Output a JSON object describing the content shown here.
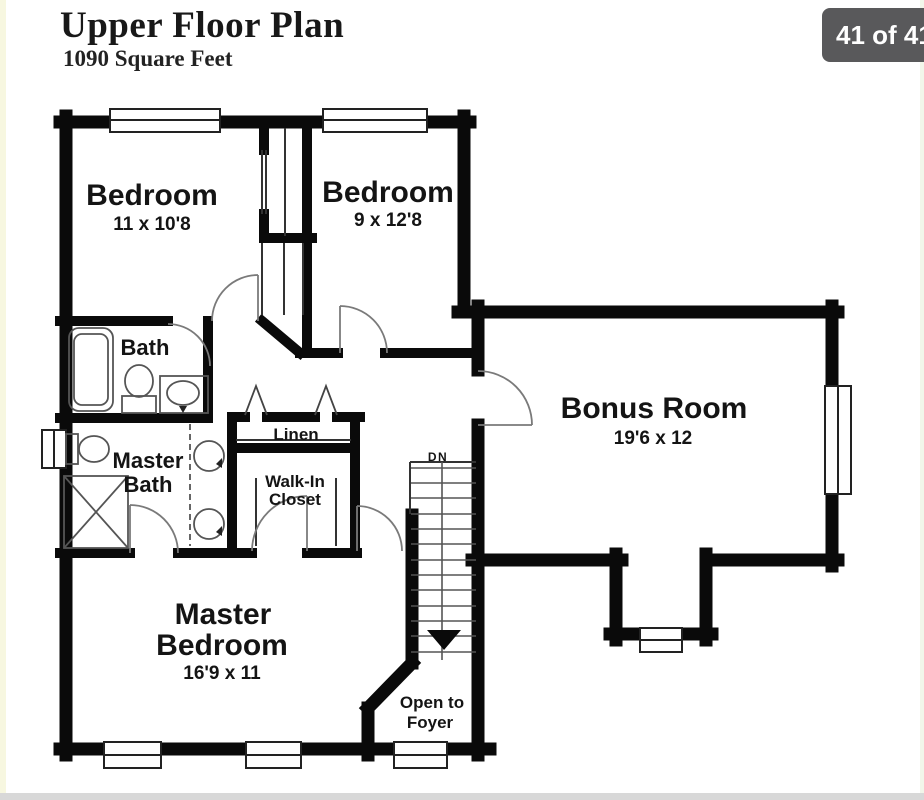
{
  "header": {
    "title": "Upper Floor Plan",
    "subtitle": "1090 Square Feet"
  },
  "badge": {
    "label": "41 of 41",
    "bg": "#59595b",
    "text_color": "#ffffff"
  },
  "page": {
    "background": "#ffffff",
    "left_strip_color": "#f7f7e0",
    "bottom_strip_color": "#d8d8d8",
    "right_strip_color": "#f2f6ea"
  },
  "plan": {
    "wall_color": "#0a0a0a",
    "label_color": "#141414",
    "door_arc_color": "#7a7a7a",
    "fixture_color": "#555555",
    "rooms": {
      "bedroom1": {
        "name": "Bedroom",
        "dims": "11 x 10'8"
      },
      "bedroom2": {
        "name": "Bedroom",
        "dims": "9 x 12'8"
      },
      "bath": {
        "name": "Bath"
      },
      "master_bath": {
        "name_line1": "Master",
        "name_line2": "Bath"
      },
      "linen": {
        "name": "Linen"
      },
      "walk_in_closet": {
        "name_line1": "Walk-In",
        "name_line2": "Closet"
      },
      "bonus_room": {
        "name": "Bonus Room",
        "dims": "19'6 x 12"
      },
      "master_bedroom": {
        "name_line1": "Master",
        "name_line2": "Bedroom",
        "dims": "16'9 x 11"
      },
      "stairs": {
        "label": "DN"
      },
      "foyer": {
        "line1": "Open to",
        "line2": "Foyer"
      }
    }
  }
}
